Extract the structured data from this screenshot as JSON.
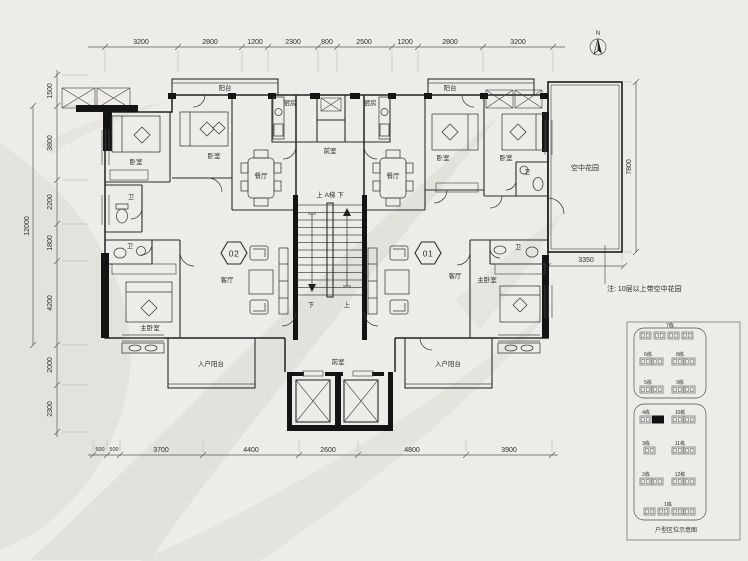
{
  "north_label": "N",
  "dimensions": {
    "top": [
      "3200",
      "2800",
      "1200",
      "2300",
      "800",
      "2500",
      "1200",
      "2800",
      "3200"
    ],
    "left": [
      "1500",
      "3800",
      "2200",
      "1800",
      "4200",
      "2000",
      "2300"
    ],
    "left_overall": "12000",
    "bottom": [
      "500",
      "500",
      "3700",
      "4400",
      "2600",
      "4800",
      "3900"
    ],
    "sky_height": "7800",
    "sky_width": "3350"
  },
  "note": "注: 10层以上带空中花园",
  "units": {
    "left": "02",
    "right": "01"
  },
  "rooms": {
    "balcony": "阳台",
    "entry_balcony": "入户阳台",
    "kitchen": "厨房",
    "dining": "餐厅",
    "living": "客厅",
    "bedroom": "卧室",
    "master_bedroom": "主卧室",
    "bath": "卫",
    "vestibule": "前室",
    "sky_garden": "空中花园",
    "stair": "上 A梯 下",
    "up": "上",
    "down": "下"
  },
  "keyplan": {
    "caption": "户型区位示意图",
    "blocks": [
      "7栋",
      "6栋",
      "8栋",
      "5栋",
      "9栋",
      "4栋",
      "10栋",
      "3栋",
      "11栋",
      "2栋",
      "12栋",
      "1栋"
    ]
  }
}
